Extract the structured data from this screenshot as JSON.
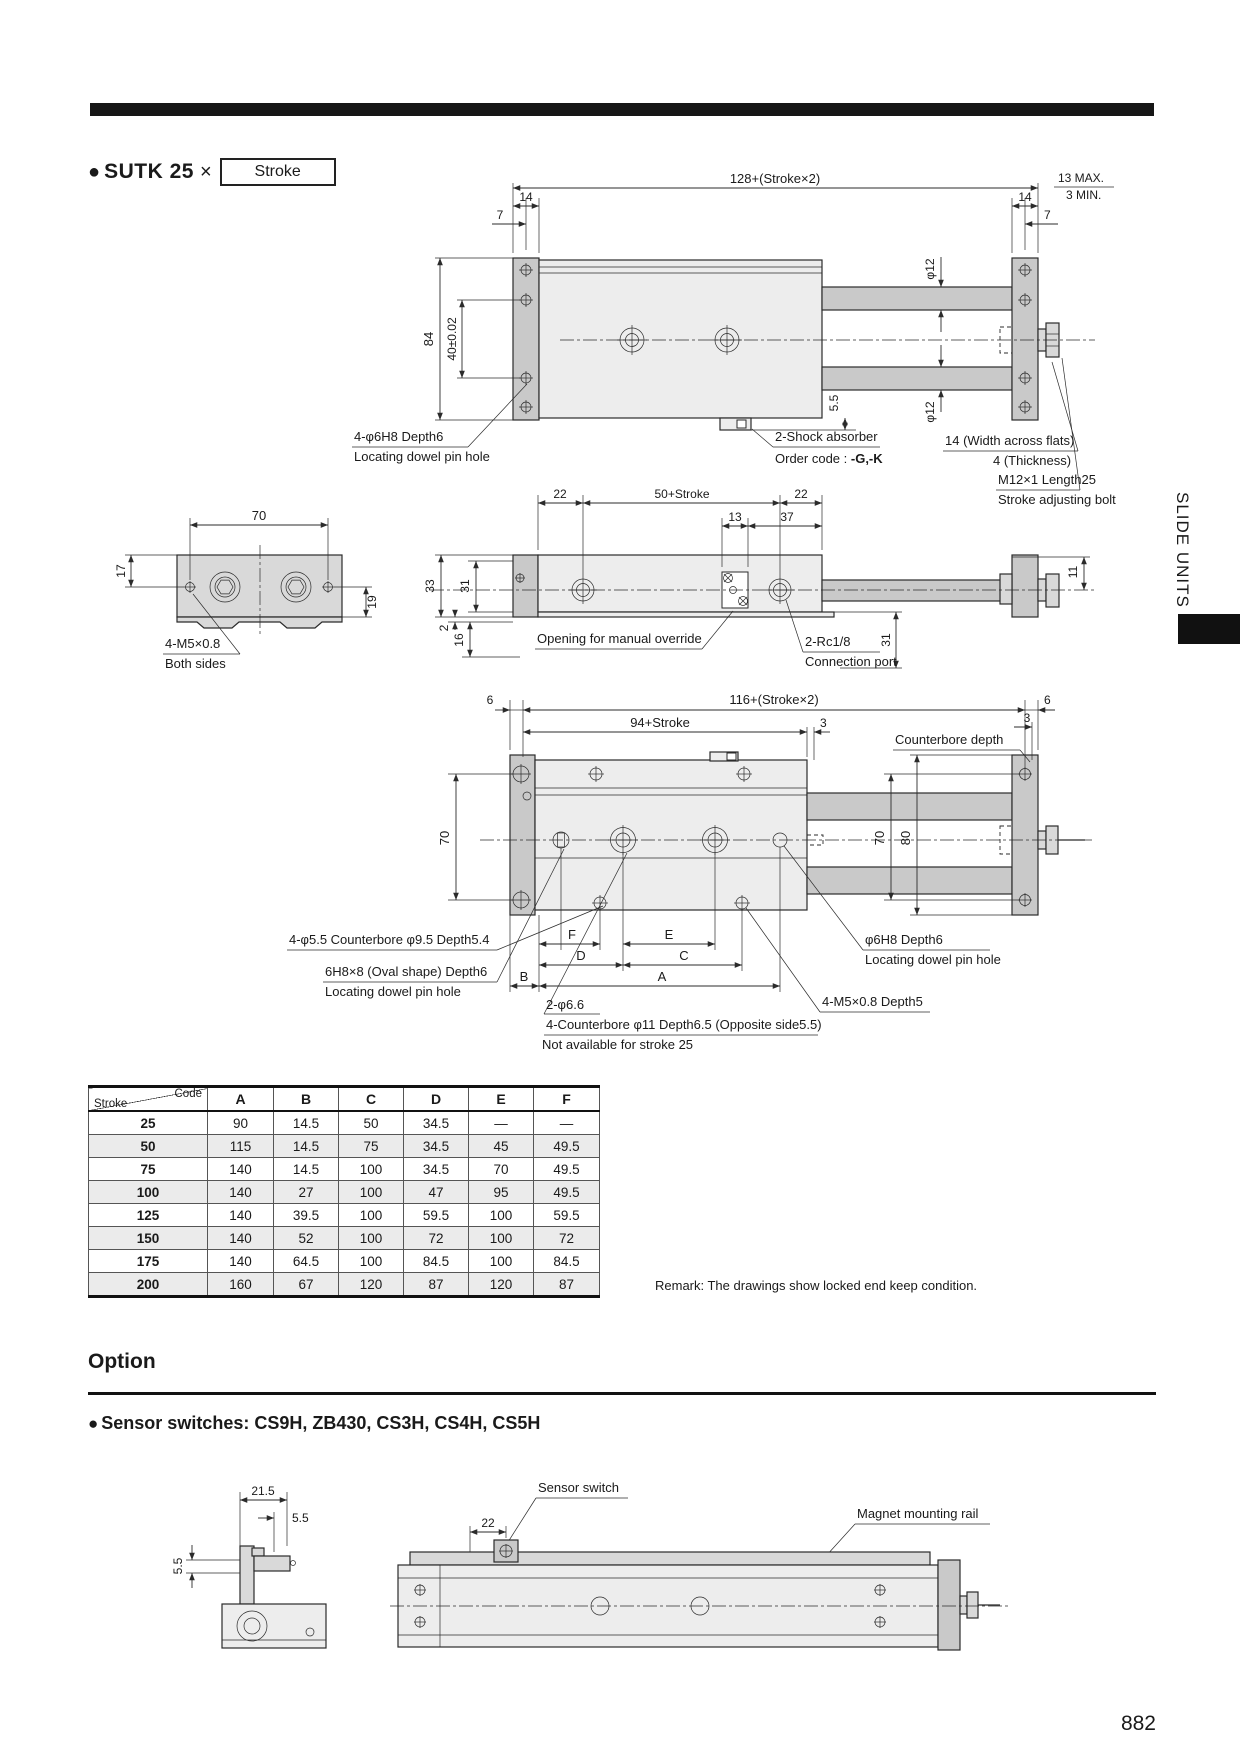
{
  "page": {
    "number": "882",
    "side_tab": "SLIDE UNITS"
  },
  "title": {
    "bullet": "●",
    "model": "SUTK 25",
    "multiply": "×",
    "stroke_box": "Stroke"
  },
  "front_view": {
    "overall": "128+(Stroke×2)",
    "max13": "13 MAX.",
    "min3": "3 MIN.",
    "w14l": "14",
    "w7l": "7",
    "w14r": "14",
    "w7r": "7",
    "h84": "84",
    "h40": "40±0.02",
    "phi12top": "φ12",
    "phi12bot": "φ12",
    "d55": "5.5",
    "dowel1": "4-φ6H8 Depth6",
    "dowel2": "Locating dowel pin hole",
    "shock1": "2-Shock absorber",
    "shock2a": "Order code : ",
    "shock2b": "-G,-K",
    "flats": "14 (Width across flats)",
    "thick": "4 (Thickness)",
    "bolt1": "M12×1 Length25",
    "bolt2": "Stroke adjusting bolt"
  },
  "side_view": {
    "w70": "70",
    "h17": "17",
    "h19": "19",
    "m5": "4-M5×0.8",
    "both": "Both sides"
  },
  "top_view": {
    "d22l": "22",
    "d50": "50+Stroke",
    "d22r": "22",
    "d13": "13",
    "d37": "37",
    "h33": "33",
    "h31": "31",
    "d2": "2",
    "d16": "16",
    "d31r": "31",
    "d11": "11",
    "override": "Opening for manual override",
    "rc1": "2-Rc1/8",
    "rc2": "Connection port"
  },
  "plan_view": {
    "overall": "116+(Stroke×2)",
    "d94": "94+Stroke",
    "d6l": "6",
    "d6r": "6",
    "d3a": "3",
    "d3b": "3",
    "cbdepth": "Counterbore depth",
    "h70l": "70",
    "h70r": "70",
    "h80": "80",
    "lA": "A",
    "lB": "B",
    "lC": "C",
    "lD": "D",
    "lE": "E",
    "lF": "F",
    "cb55": "4-φ5.5 Counterbore φ9.5  Depth5.4",
    "oval1": "6H8×8 (Oval shape) Depth6",
    "oval2": "Locating dowel pin hole",
    "phi66": "2-φ6.6",
    "cb11": "4-Counterbore φ11 Depth6.5 (Opposite side5.5)",
    "na25": "Not available for stroke 25",
    "dowel1": "φ6H8 Depth6",
    "dowel2": "Locating dowel pin hole",
    "m5d5": "4-M5×0.8 Depth5"
  },
  "dim_table": {
    "corner_code": "Code",
    "corner_stroke": "Stroke",
    "columns": [
      "A",
      "B",
      "C",
      "D",
      "E",
      "F"
    ],
    "rows": [
      {
        "stroke": "25",
        "values": [
          "90",
          "14.5",
          "50",
          "34.5",
          "—",
          "—"
        ]
      },
      {
        "stroke": "50",
        "values": [
          "115",
          "14.5",
          "75",
          "34.5",
          "45",
          "49.5"
        ]
      },
      {
        "stroke": "75",
        "values": [
          "140",
          "14.5",
          "100",
          "34.5",
          "70",
          "49.5"
        ]
      },
      {
        "stroke": "100",
        "values": [
          "140",
          "27",
          "100",
          "47",
          "95",
          "49.5"
        ]
      },
      {
        "stroke": "125",
        "values": [
          "140",
          "39.5",
          "100",
          "59.5",
          "100",
          "59.5"
        ]
      },
      {
        "stroke": "150",
        "values": [
          "140",
          "52",
          "100",
          "72",
          "100",
          "72"
        ]
      },
      {
        "stroke": "175",
        "values": [
          "140",
          "64.5",
          "100",
          "84.5",
          "100",
          "84.5"
        ]
      },
      {
        "stroke": "200",
        "values": [
          "160",
          "67",
          "120",
          "87",
          "120",
          "87"
        ]
      }
    ]
  },
  "remark": "Remark: The drawings show locked end keep condition.",
  "option": {
    "heading": "Option",
    "bullet": "●",
    "sensor_heading": "Sensor switches: CS9H, ZB430, CS3H, CS4H, CS5H"
  },
  "sensor_view": {
    "d215": "21.5",
    "d55a": "5.5",
    "d55b": "5.5",
    "d22": "22",
    "sensor_label": "Sensor switch",
    "rail_label": "Magnet mounting rail"
  },
  "colors": {
    "page_bg": "#ffffff",
    "bar": "#161616",
    "line": "#2b2b2b",
    "body_light": "#ededed",
    "body_mid": "#c9c9c9",
    "table_shade": "#ebebeb"
  }
}
